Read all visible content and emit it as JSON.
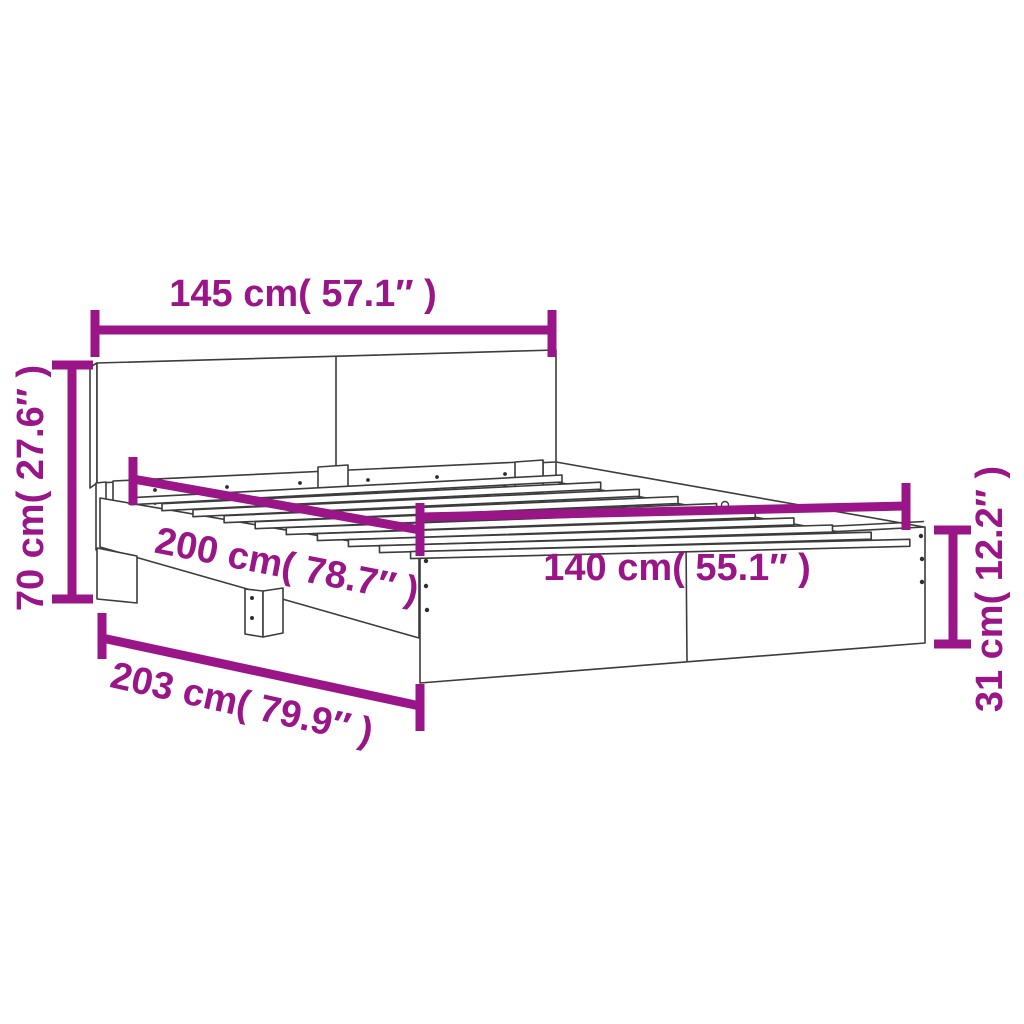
{
  "diagram": {
    "type": "product-dimension-diagram",
    "subject": "bed-frame-with-headboard"
  },
  "colors": {
    "dimension_accent": "#9A1588",
    "drawing_outline": "#3C3C3C",
    "background": "#FFFFFF"
  },
  "dimensions": {
    "headboard_width": {
      "cm": "145",
      "inches": "57.1",
      "label": "145 cm( 57.1″ )"
    },
    "headboard_height": {
      "cm": "70",
      "inches": "27.6",
      "label": "70 cm( 27.6″ )"
    },
    "frame_length": {
      "cm": "200",
      "inches": "78.7",
      "label": "200 cm( 78.7″ )"
    },
    "frame_width": {
      "cm": "140",
      "inches": "55.1",
      "label": "140 cm( 55.1″ )"
    },
    "total_length": {
      "cm": "203",
      "inches": "79.9",
      "label": "203 cm( 79.9″ )"
    },
    "side_height": {
      "cm": "31",
      "inches": "12.2",
      "label": "31 cm( 12.2″ )"
    }
  }
}
